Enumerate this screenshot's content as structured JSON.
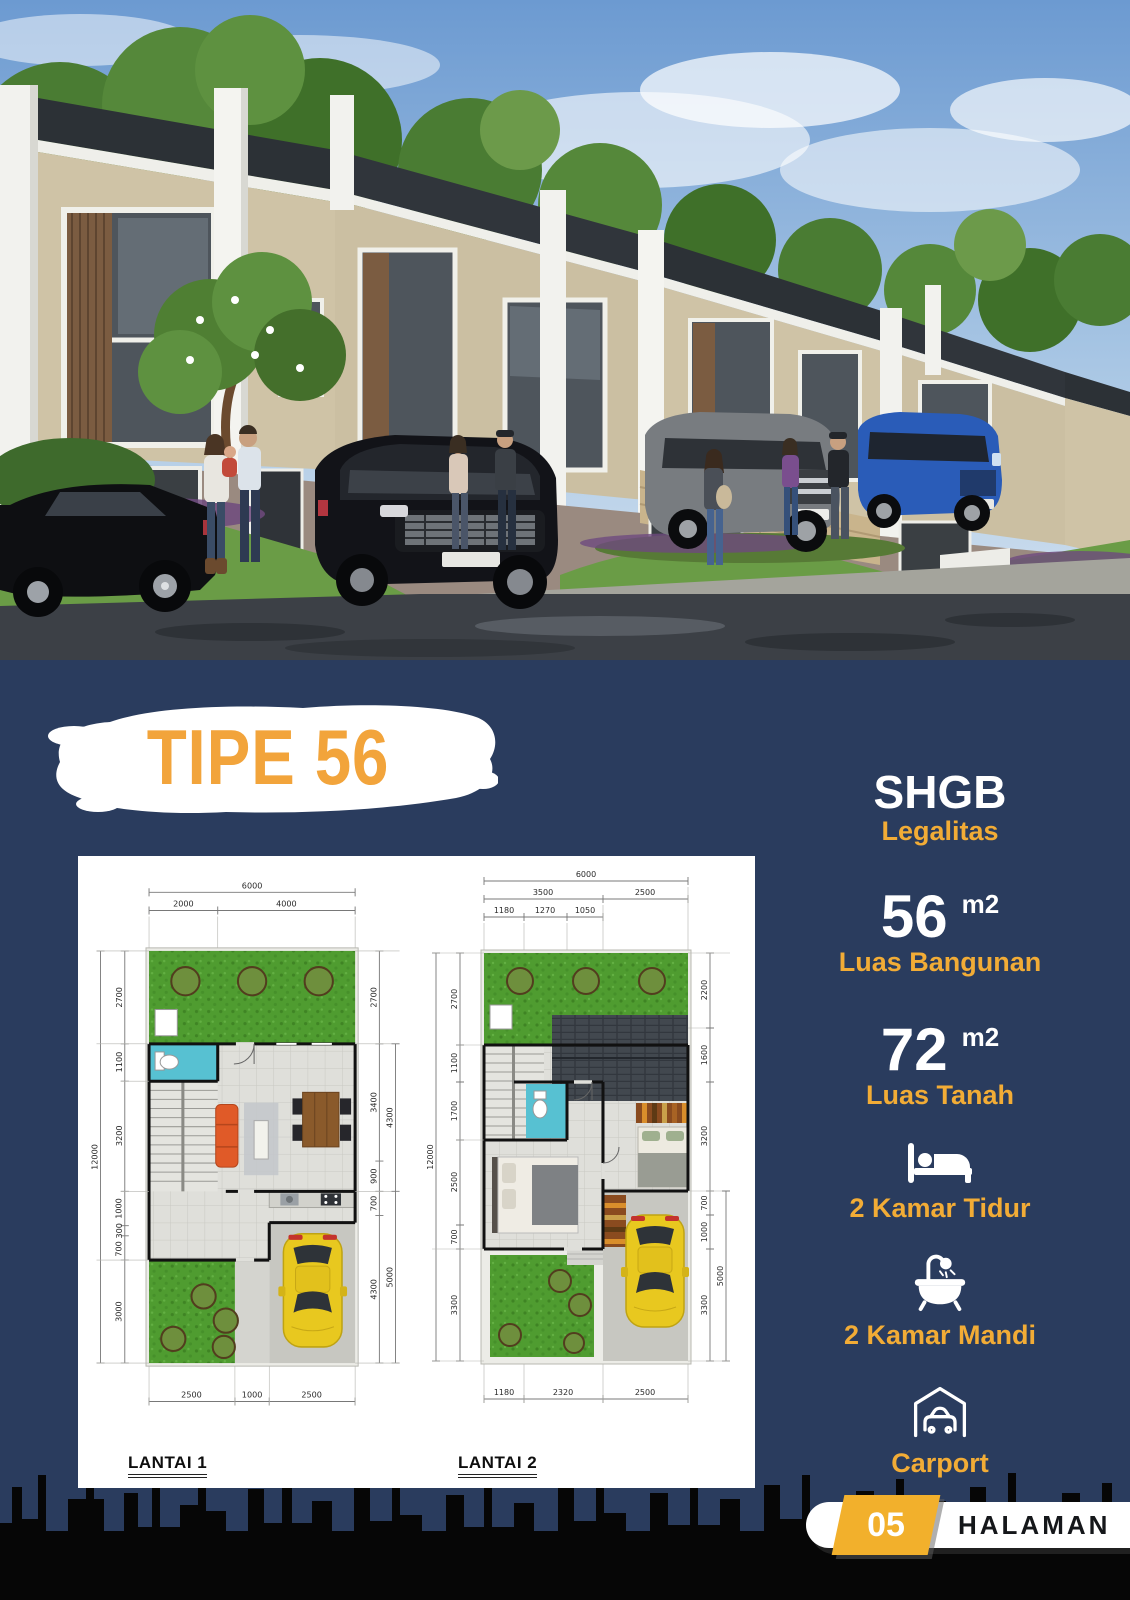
{
  "colors": {
    "background_navy": "#2A3C5E",
    "accent_yellow": "#F2AC36",
    "title_orange": "#F2A43B",
    "panel_white": "#FFFFFF",
    "skyline_black": "#060606"
  },
  "title": {
    "text": "TIPE 56"
  },
  "specs": {
    "legal": {
      "value": "SHGB",
      "label": "Legalitas"
    },
    "building": {
      "value": "56",
      "unit": "m2",
      "label": "Luas Bangunan"
    },
    "land": {
      "value": "72",
      "unit": "m2",
      "label": "Luas Tanah"
    },
    "features": [
      {
        "icon": "bed-icon",
        "label": "2 Kamar Tidur"
      },
      {
        "icon": "bathtub-icon",
        "label": "2 Kamar Mandi"
      },
      {
        "icon": "carport-icon",
        "label": "Carport"
      }
    ]
  },
  "floorplans": {
    "plan1": {
      "label": "LANTAI 1",
      "dims_top": [
        "6000",
        "2000",
        "4000"
      ],
      "dims_bottom": [
        "2500",
        "1000",
        "2500"
      ],
      "dims_left": [
        "12000",
        "2700",
        "1100",
        "3200",
        "1000",
        "300",
        "700",
        "3000"
      ],
      "dims_right": [
        "2700",
        "3400",
        "900",
        "700",
        "4300",
        "4300",
        "5000"
      ]
    },
    "plan2": {
      "label": "LANTAI 2",
      "dims_top": [
        "6000",
        "3500",
        "2500",
        "1180",
        "1270",
        "1050"
      ],
      "dims_bottom": [
        "1180",
        "2320",
        "2500"
      ],
      "dims_left": [
        "12000",
        "2700",
        "1100",
        "1700",
        "2500",
        "700",
        "3300"
      ],
      "dims_right": [
        "2200",
        "1600",
        "3200",
        "700",
        "1000",
        "3300",
        "5000"
      ]
    }
  },
  "footer": {
    "page_number": "05",
    "page_label": "HALAMAN"
  }
}
